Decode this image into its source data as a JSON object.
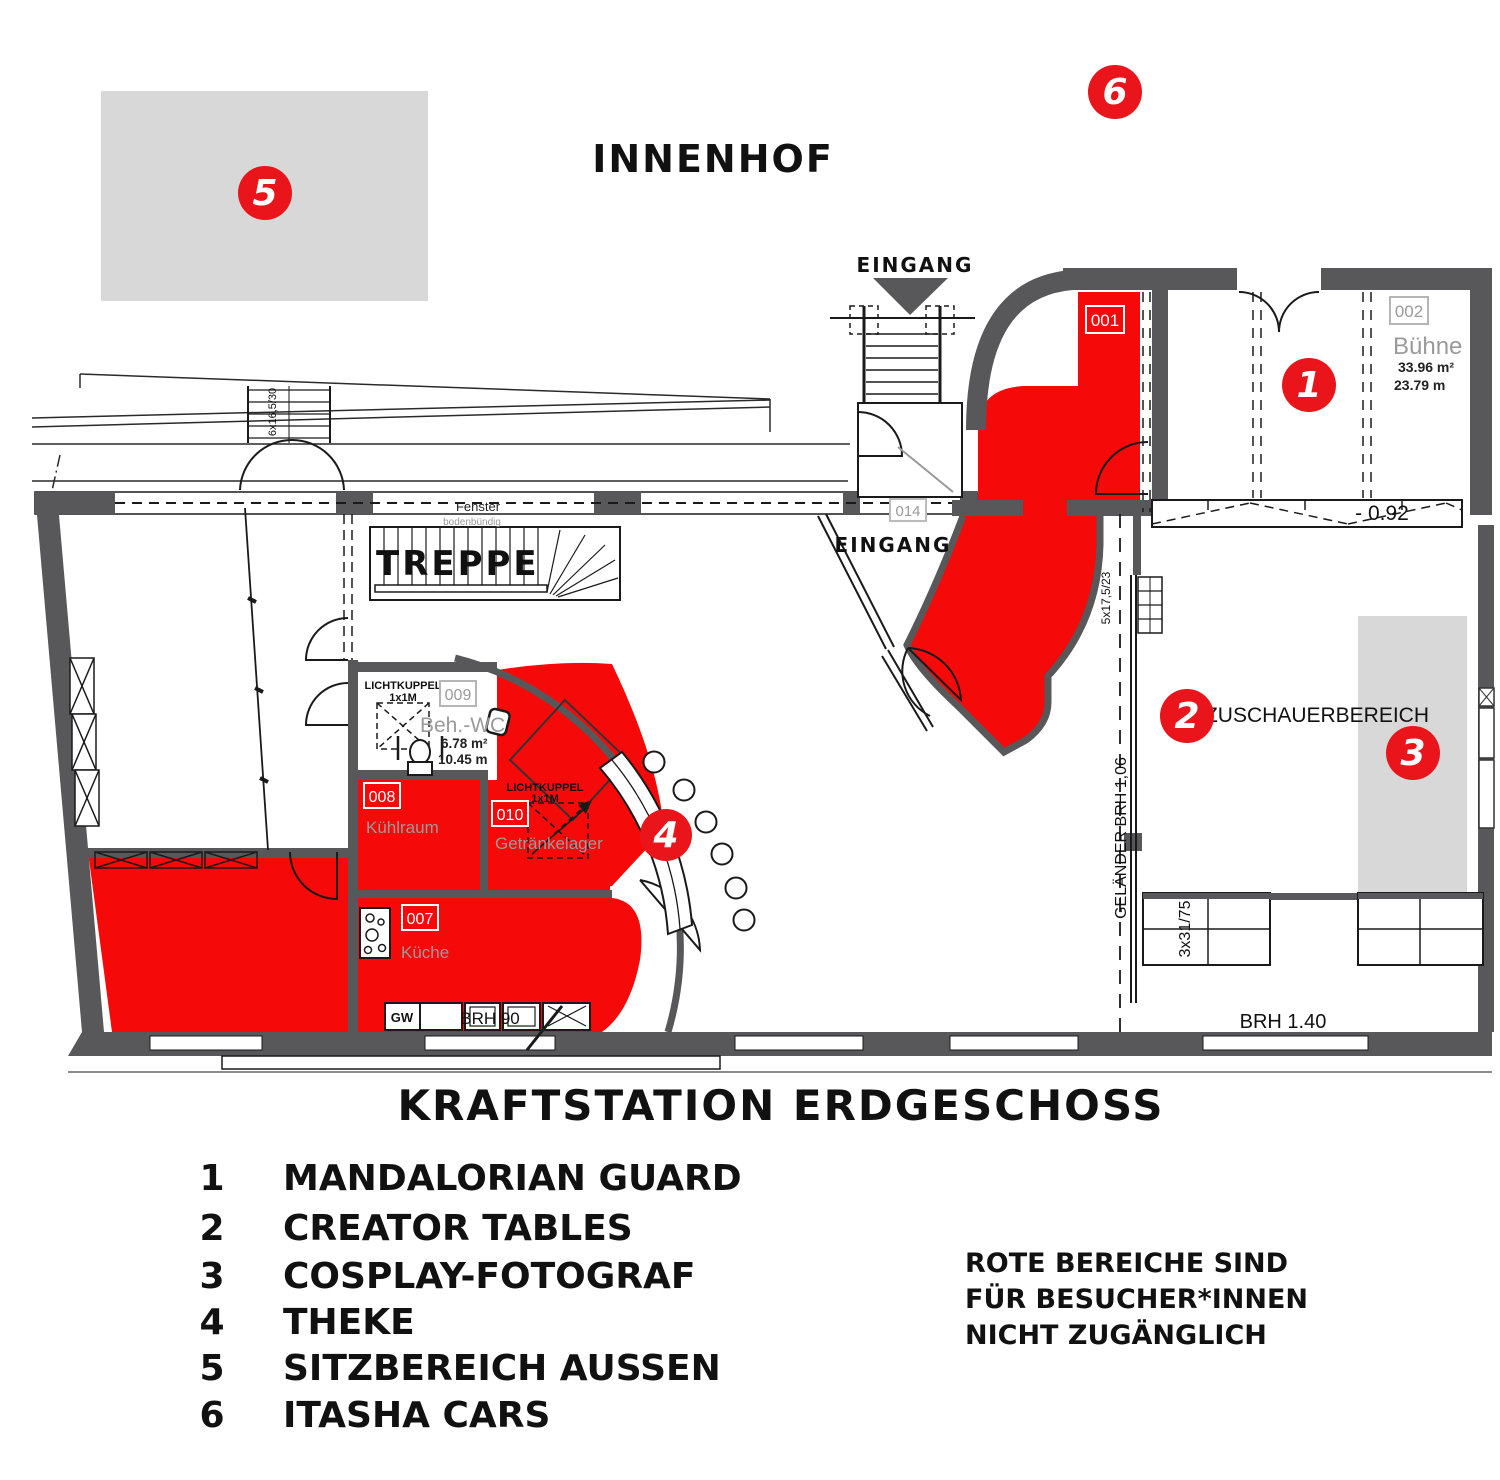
{
  "colors": {
    "red_area": "#f60909",
    "red_badge": "#e9151b",
    "wall_gray": "#58585a",
    "light_gray": "#d8d8d8",
    "label_gray": "#9a9a9a"
  },
  "courtyard": {
    "title": "INNENHOF"
  },
  "plan_title": "KRAFTSTATION ERDGESCHOSS",
  "entrances": {
    "top": "EINGANG",
    "inner": "EINGANG"
  },
  "stairs_label": "TREPPE",
  "fenster": {
    "label": "Fenster",
    "note": "bodenbündig"
  },
  "rooms": {
    "r001": {
      "id": "001"
    },
    "r002": {
      "id": "002",
      "name": "Bühne",
      "area": "33.96 m²",
      "len": "23.79 m"
    },
    "r007": {
      "id": "007",
      "name": "Küche"
    },
    "r008": {
      "id": "008",
      "name": "Kühlraum"
    },
    "r009": {
      "id": "009",
      "name": "Beh.-WC",
      "area": "6.78 m²",
      "len": "10.45 m"
    },
    "r010": {
      "id": "010",
      "name": "Getränkelager"
    },
    "r014": {
      "id": "014"
    }
  },
  "skylight": {
    "line1": "LICHTKUPPEL",
    "line2": "1x1M"
  },
  "audience": {
    "label": "ZUSCHAUERBEREICH"
  },
  "dims": {
    "railing": "GELÄNDER BRH 1,06",
    "stair_top": "6x16,5/30",
    "stair_right": "5x17,5/23",
    "steps": "3x31/75",
    "sill_kitchen": "BRH 90",
    "sill_right": "BRH 1.40",
    "stage_level": "- 0.92",
    "gw": "GW"
  },
  "markers": [
    {
      "num": "1",
      "label": "MANDALORIAN GUARD"
    },
    {
      "num": "2",
      "label": "CREATOR TABLES"
    },
    {
      "num": "3",
      "label": "COSPLAY-FOTOGRAF"
    },
    {
      "num": "4",
      "label": "THEKE"
    },
    {
      "num": "5",
      "label": "SITZBEREICH AUSSEN"
    },
    {
      "num": "6",
      "label": "ITASHA CARS"
    }
  ],
  "note": {
    "line1": "ROTE BEREICHE SIND",
    "line2": "FÜR BESUCHER*INNEN",
    "line3": "NICHT ZUGÄNGLICH"
  }
}
